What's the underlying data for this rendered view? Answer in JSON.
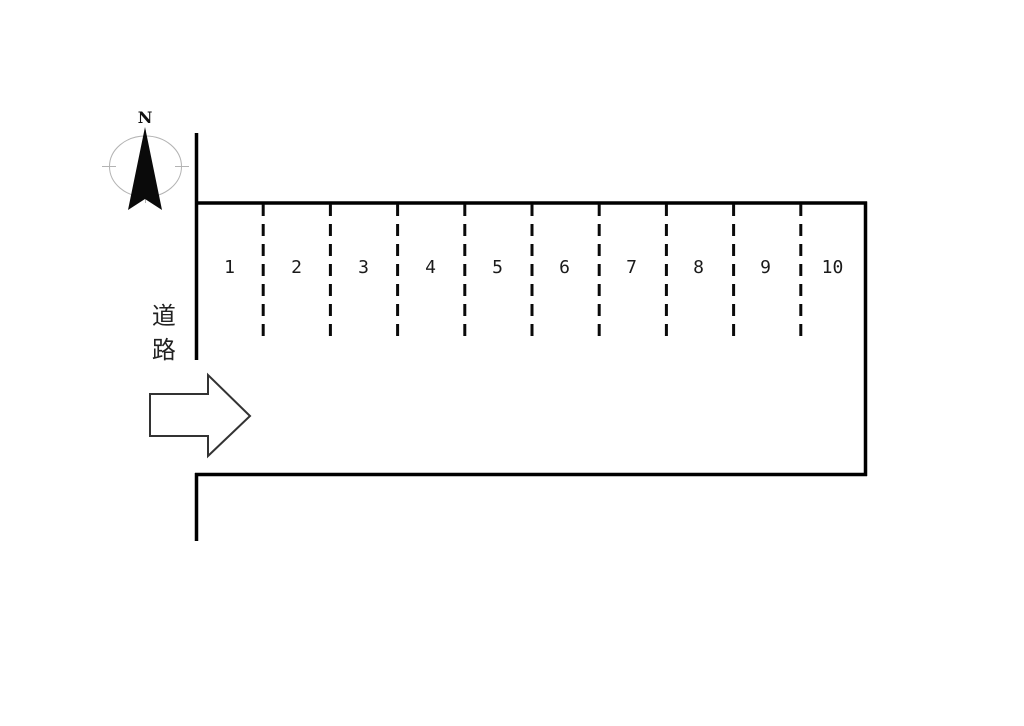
{
  "title": "parking-lot-site-plan",
  "compass": {
    "north_label": "N",
    "needle_icon": "north-needle"
  },
  "road": {
    "label": "道路"
  },
  "entrance": {
    "arrow_icon": "arrow-right"
  },
  "parking": {
    "spaces": [
      "1",
      "2",
      "3",
      "4",
      "5",
      "6",
      "7",
      "8",
      "9",
      "10"
    ]
  },
  "colors": {
    "line": "#000000",
    "compass_ring": "#b3b3b3",
    "arrow_outline": "#333333"
  }
}
